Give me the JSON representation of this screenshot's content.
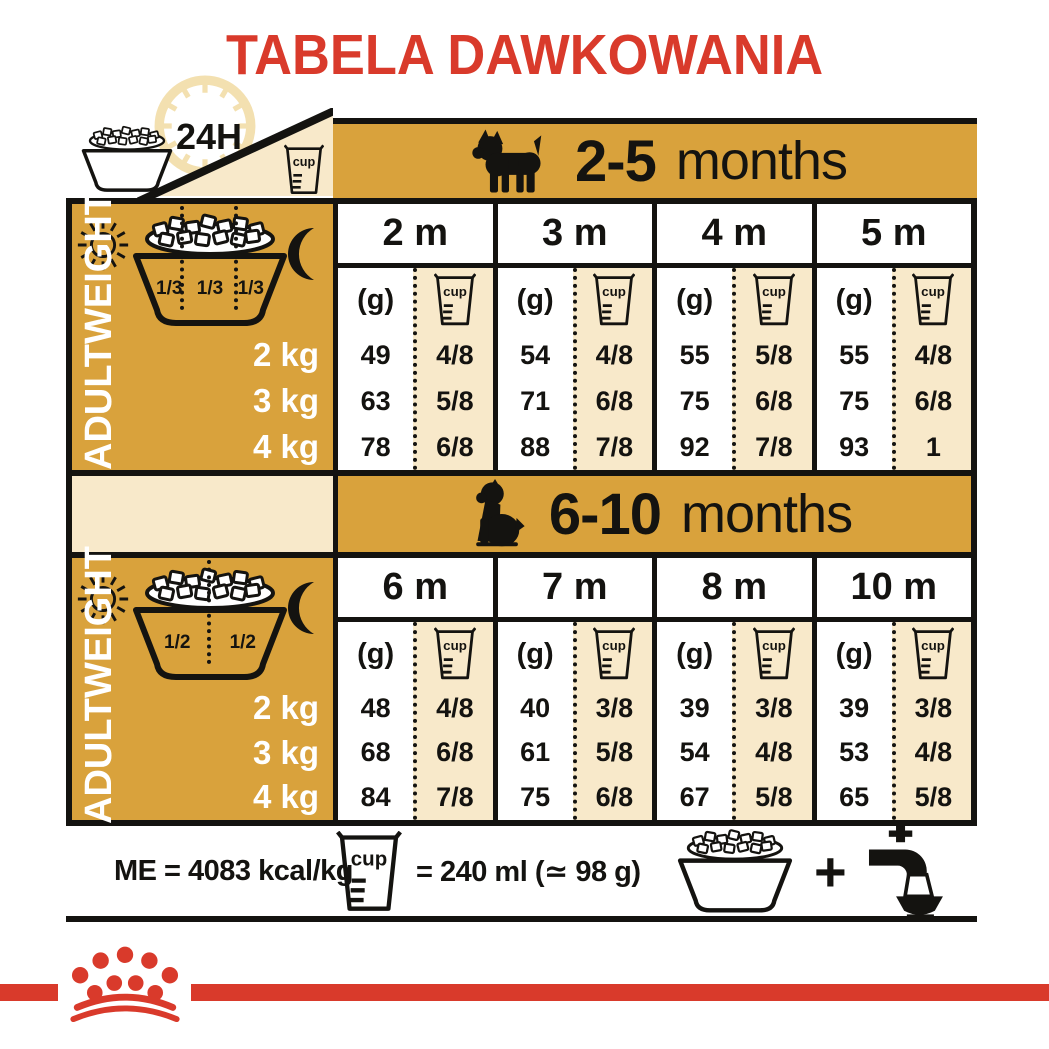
{
  "title": "TABELA DAWKOWANIA",
  "icons": {
    "cup": "cup",
    "hours": "24H",
    "plus": "+"
  },
  "colors": {
    "gold": "#D9A23C",
    "cream": "#F8E9CA",
    "red": "#D93A2B",
    "ink": "#141310"
  },
  "tables": [
    {
      "age_range": "2-5",
      "age_word": "months",
      "portions": [
        "1/3",
        "1/3",
        "1/3"
      ],
      "adult_weight_line1": "ADULT",
      "adult_weight_line2": "WEIGHT",
      "weights": [
        "2 kg",
        "3 kg",
        "4 kg"
      ],
      "unit_g": "(g)",
      "columns": [
        {
          "month": "2 m",
          "g": [
            "49",
            "63",
            "78"
          ],
          "cup": [
            "4/8",
            "5/8",
            "6/8"
          ]
        },
        {
          "month": "3 m",
          "g": [
            "54",
            "71",
            "88"
          ],
          "cup": [
            "4/8",
            "6/8",
            "7/8"
          ]
        },
        {
          "month": "4 m",
          "g": [
            "55",
            "75",
            "92"
          ],
          "cup": [
            "5/8",
            "6/8",
            "7/8"
          ]
        },
        {
          "month": "5 m",
          "g": [
            "55",
            "75",
            "93"
          ],
          "cup": [
            "4/8",
            "6/8",
            "1"
          ]
        }
      ]
    },
    {
      "age_range": "6-10",
      "age_word": "months",
      "portions": [
        "1/2",
        "1/2"
      ],
      "adult_weight_line1": "ADULT",
      "adult_weight_line2": "WEIGHT",
      "weights": [
        "2 kg",
        "3 kg",
        "4 kg"
      ],
      "unit_g": "(g)",
      "columns": [
        {
          "month": "6 m",
          "g": [
            "48",
            "68",
            "84"
          ],
          "cup": [
            "4/8",
            "6/8",
            "7/8"
          ]
        },
        {
          "month": "7 m",
          "g": [
            "40",
            "61",
            "75"
          ],
          "cup": [
            "3/8",
            "5/8",
            "6/8"
          ]
        },
        {
          "month": "8 m",
          "g": [
            "39",
            "54",
            "67"
          ],
          "cup": [
            "3/8",
            "4/8",
            "5/8"
          ]
        },
        {
          "month": "10 m",
          "g": [
            "39",
            "53",
            "65"
          ],
          "cup": [
            "3/8",
            "4/8",
            "5/8"
          ]
        }
      ]
    }
  ],
  "footer": {
    "me": "ME = 4083 kcal/kg",
    "cup_equiv": "= 240 ml (≃ 98 g)"
  }
}
